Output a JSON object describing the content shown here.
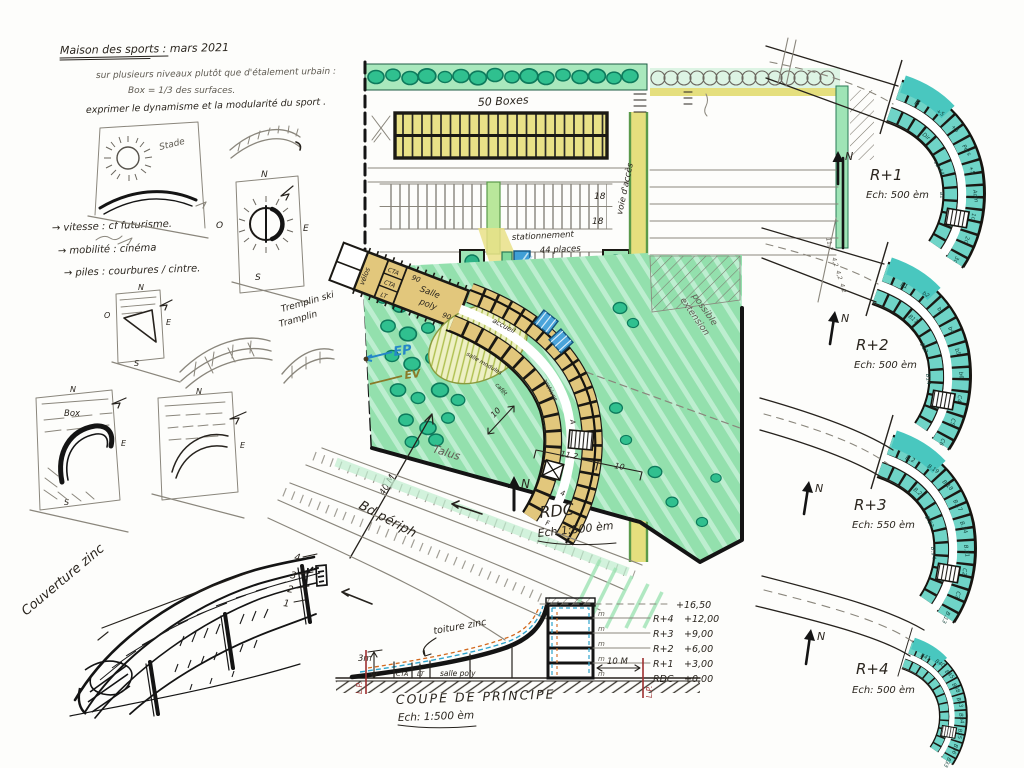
{
  "notes": {
    "title": "Maison des sports : mars 2021",
    "line1": "sur plusieurs niveaux plutôt que d'étalement urbain :",
    "line2": "Box = 1/3 des surfaces.",
    "line3": "exprimer le dynamisme et la modularité du sport .",
    "bullet1": "→ vitesse : cf futurisme.",
    "bullet2": "→ mobilité : cinéma",
    "bullet3": "→ piles : courbures / cintre.",
    "stade": "Stade",
    "tremplin1": "Tremplin ski",
    "tremplin2": "Tramplin",
    "box": "Box"
  },
  "compass": {
    "n": "N",
    "s": "S",
    "e": "E",
    "o": "O"
  },
  "site_plan": {
    "boxes_label": "50 Boxes",
    "parking_row1": "18",
    "parking_row2": "18",
    "parking_row3": "8",
    "parking_label1": "stationnement",
    "parking_label2": "44 places",
    "access_road": "voie d'accès",
    "rooms": {
      "velos": "vélos",
      "cta": "CTA",
      "lt": "LT",
      "salle": "Salle",
      "poly": "poly",
      "d90a": "90",
      "d90b": "90",
      "accueil": "accueil",
      "modules": "salle modules",
      "cafet": "cafét",
      "archives": "archives",
      "a": "A",
      "f": "F",
      "q4": "4"
    },
    "extension1": "extension",
    "extension2": "possible",
    "ep": "EP",
    "ev": "EV",
    "talus": "Talus",
    "bd_periph": "Bd périph",
    "dim40": "40 M",
    "dim10a": "10",
    "dim112": "11.2",
    "dim10b": "10",
    "north": "N",
    "caption": "RDC",
    "scale": "Ech 1:500 èm"
  },
  "floors": [
    {
      "name": "R+1",
      "scale": "Ech: 500 èm",
      "north": "N",
      "rooms": [
        "B",
        "+5",
        "+5",
        "Pers",
        "+5",
        "Adm",
        "1c",
        "2c",
        "3c",
        "Dir",
        "cd 44",
        "a1"
      ]
    },
    {
      "name": "R+2",
      "scale": "Ech: 500 èm",
      "north": "N",
      "rooms": [
        "b1",
        "b2",
        "b3",
        "b4",
        "b5",
        "b6",
        "C4",
        "C5",
        "C6",
        "B11",
        "B12",
        "B14"
      ],
      "dims": [
        "11,2",
        "4,2",
        "4,2",
        "4,2"
      ]
    },
    {
      "name": "R+3",
      "scale": "Ech: 550 èm",
      "north": "N",
      "rooms": [
        "B.2",
        "B.19",
        "B.18",
        "B.17",
        "B.24",
        "B.21",
        "C2",
        "C3",
        "B.13",
        "B.22",
        "B.23",
        "B.14"
      ]
    },
    {
      "name": "R+4",
      "scale": "Ech: 500 èm",
      "north": "N",
      "rooms": [
        "B41",
        "B40",
        "B45",
        "B38",
        "B43",
        "B34",
        "B35",
        "B36",
        "B33",
        "",
        "",
        ""
      ]
    }
  ],
  "perspective": {
    "label": "Couverture zinc",
    "levels": [
      "4",
      "3",
      "2",
      "1"
    ]
  },
  "section": {
    "caption1": "COUPE DE PRINCIPE",
    "caption2": "Ech: 1:500 èm",
    "toiture": "toiture zinc",
    "room1": "CTA",
    "room2": "LT",
    "room3": "salle poly",
    "dim3m": "3m",
    "dim10m": "10 M",
    "lp_left": "L.P.",
    "lp_right": "L.P.",
    "top_level": "+16,50",
    "levels": [
      {
        "name": "R+4",
        "value": "+12,00"
      },
      {
        "name": "R+3",
        "value": "+9,00"
      },
      {
        "name": "R+2",
        "value": "+6,00"
      },
      {
        "name": "R+1",
        "value": "+3,00"
      },
      {
        "name": "RDC",
        "value": "+0,00"
      }
    ],
    "m1": "m",
    "m2": "m",
    "m3": "m",
    "m4": "m",
    "m5": "m"
  }
}
